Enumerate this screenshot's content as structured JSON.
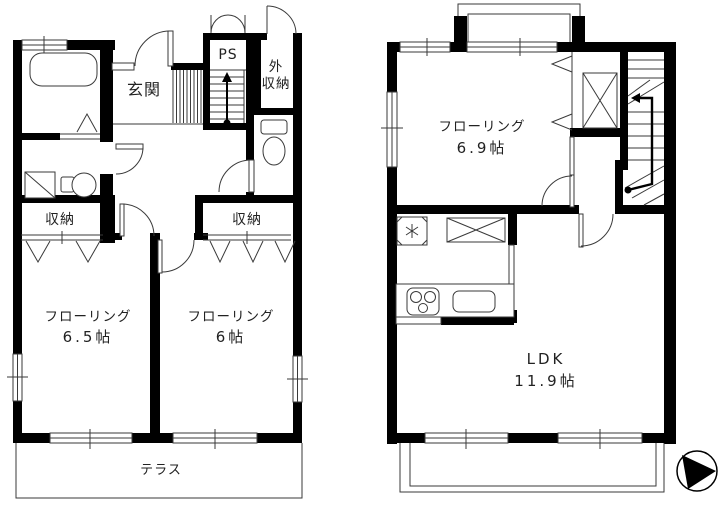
{
  "colors": {
    "wall": "#000000",
    "line": "#3a3a3a",
    "text": "#222222",
    "background": "#ffffff"
  },
  "floor1": {
    "entrance_label": "玄関",
    "ps_label": "PS",
    "exterior_storage_line1": "外",
    "exterior_storage_line2": "収納",
    "closet_left_label": "収納",
    "closet_right_label": "収納",
    "room_a": {
      "name": "フローリング",
      "size": "6.5帖"
    },
    "room_b": {
      "name": "フローリング",
      "size": "6帖"
    },
    "terrace_label": "テラス"
  },
  "floor2": {
    "room_c": {
      "name": "フローリング",
      "size": "6.9帖"
    },
    "ldk": {
      "name": "LDK",
      "size": "11.9帖"
    }
  }
}
